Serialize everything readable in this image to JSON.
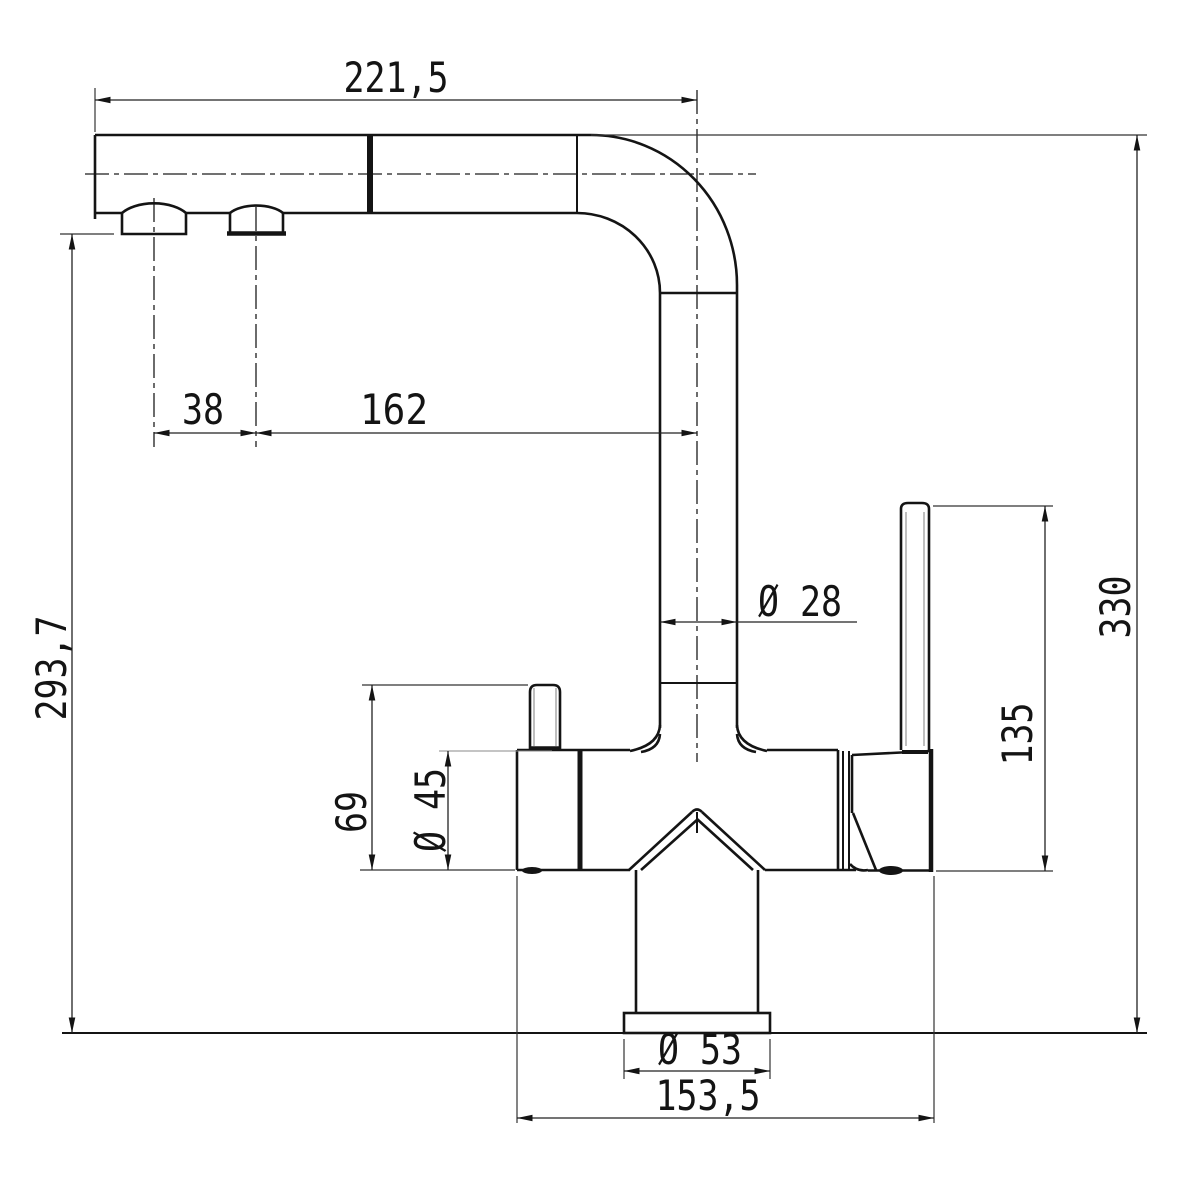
{
  "drawing": {
    "type": "technical-dimension-drawing",
    "subject": "kitchen-faucet-side-view",
    "unit_style": "millimetres-comma-decimal",
    "line_color": "#141414",
    "background_color": "#ffffff",
    "dimensions": {
      "spout_reach": "221,5",
      "aerator_spacing": "38",
      "aerator_to_axis": "162",
      "outlet_height": "293,7",
      "total_height": "330",
      "pipe_diameter": "Ø 28",
      "handle_height": "135",
      "knob_height": "69",
      "body_diameter": "Ø 45",
      "base_diameter": "Ø 53",
      "body_length": "153,5"
    }
  }
}
